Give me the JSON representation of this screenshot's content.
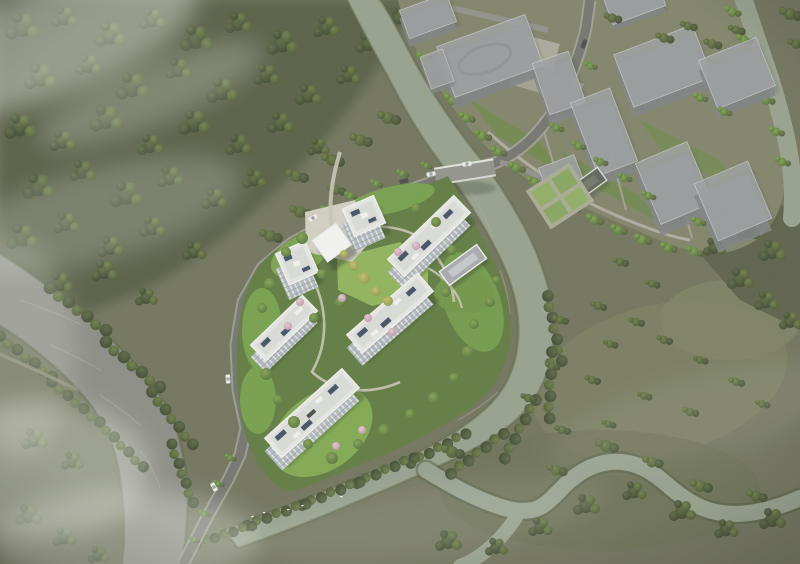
{
  "meta": {
    "description": "Aerial architectural rendering of a riverside residential development: six white mid-rise buildings around a central garden on a peninsula, a ghosted gray building massing district to the northeast, forest to the northwest, and braided gray-green rivers with a bridge, roads, cars and waterfowl."
  },
  "palette": {
    "ground": "#6f725a",
    "ground_dark": "#5a5e46",
    "forest": "#555c43",
    "water": "#8a8c83",
    "water_light": "#96a08c",
    "road": "#72736c",
    "road_edge": "#a2a299",
    "path": "#cac7b6",
    "bridge": "#91928b",
    "site_green": "#5e7a3e",
    "lawn": "#7aa24b",
    "lawn_bright": "#8fb457",
    "building_roof": "#e8e9e5",
    "building_rim": "#f6f7f3",
    "facade": "#b3bac0",
    "solar": "#3e4e62",
    "canopy": "#f7f8f5",
    "ghost_roof": "#9ea0a3",
    "ghost_face": "#7e8184",
    "amenity_roof": "#a6abaf",
    "dark_roof": "#5f6259",
    "plaza": "#b0ada2",
    "garden_hedge": "#8fae62",
    "car_white": "#f1f2ee",
    "car_dark": "#45474a",
    "bird": "#f4f5f1",
    "haze": "#eceee8"
  },
  "scene": {
    "labels": {
      "central_site": "white residential cluster with central garden",
      "north_district": "ghosted massing buildings district",
      "forest": "northwest woodland",
      "rivers": "river network with confluence",
      "bridge": "road bridge over river"
    },
    "counts": {
      "white_residential_buildings": 6,
      "massing_buildings": 11,
      "entrance_canopy": 1,
      "amenity_buildings": 2,
      "cars": 7,
      "birds": 5,
      "river_branches": 4
    }
  }
}
